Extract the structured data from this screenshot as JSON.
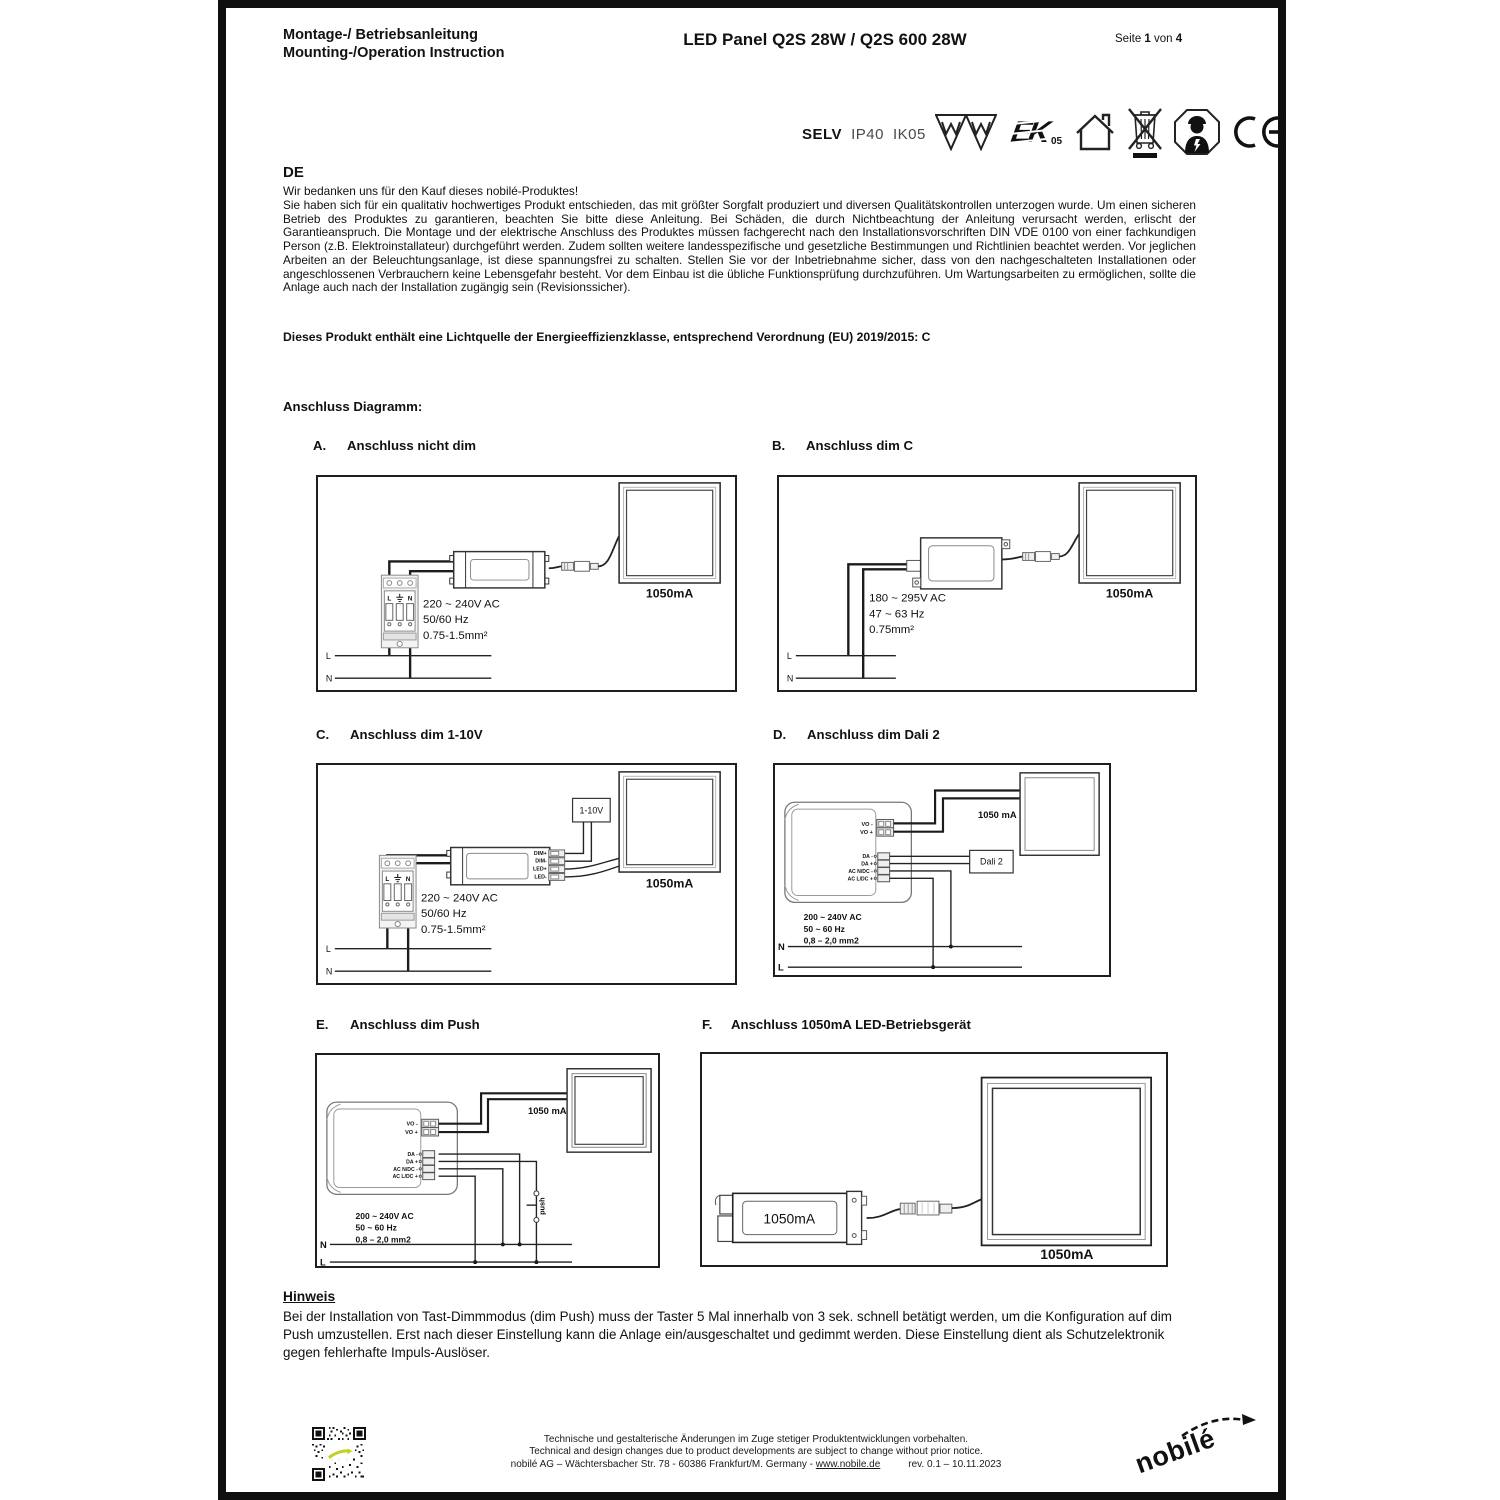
{
  "header": {
    "doc_title_line1": "Montage-/ Betriebsanleitung",
    "doc_title_line2": "Mounting-/Operation Instruction",
    "product_title": "LED Panel Q2S 28W / Q2S 600 28W",
    "page_prefix": "Seite ",
    "page_number": "1",
    "page_middle": " von ",
    "page_total": "4"
  },
  "certs": {
    "selv": "SELV",
    "ip": "IP40",
    "ik": "IK05",
    "enec_text": "EK",
    "enec_number": "05",
    "icons": [
      "selv-label",
      "ip-rating",
      "ik-rating",
      "transformer-triangle-icon",
      "transformer-triangle-icon",
      "enec-mark-icon",
      "indoor-use-icon",
      "weee-bin-icon",
      "electrician-icon",
      "ce-mark-icon"
    ]
  },
  "intro": {
    "lang": "DE",
    "greeting": "Wir bedanken uns für den Kauf dieses nobilé-Produktes!",
    "body": "Sie haben sich für ein qualitativ hochwertiges Produkt entschieden, das mit größter Sorgfalt produziert und diversen Qualitätskontrollen unterzogen wurde. Um einen sicheren Betrieb des Produktes zu garantieren, beachten Sie bitte diese Anleitung. Bei Schäden, die durch Nichtbeachtung der Anleitung verursacht werden, erlischt der Garantieanspruch. Die Montage und der elektrische Anschluss des Produktes müssen fachgerecht nach den Installationsvorschriften DIN VDE 0100 von einer fachkundigen Person (z.B. Elektroinstallateur) durchgeführt werden. Zudem sollten weitere landesspezifische und gesetzliche Bestimmungen und Richtlinien beachtet werden. Vor jeglichen Arbeiten an der Beleuchtungsanlage, ist diese spannungsfrei zu schalten. Stellen Sie vor der Inbetriebnahme sicher, dass von den nachgeschalteten Installationen oder angeschlossenen Verbrauchern keine Lebensgefahr besteht. Vor dem Einbau ist die übliche Funktionsprüfung durchzuführen. Um Wartungsarbeiten zu ermöglichen, sollte die Anlage auch nach der Installation zugängig sein (Revisionssicher).",
    "energy_note": "Dieses Produkt enthält eine Lichtquelle der Energieeffizienzklasse, entsprechend Verordnung (EU) 2019/2015: C"
  },
  "diagram_heading": "Anschluss Diagramm:",
  "sections": {
    "a": {
      "letter": "A.",
      "title": "Anschluss nicht dim"
    },
    "b": {
      "letter": "B.",
      "title": "Anschluss dim C"
    },
    "c": {
      "letter": "C.",
      "title": "Anschluss dim 1-10V"
    },
    "d": {
      "letter": "D.",
      "title": "Anschluss dim Dali 2"
    },
    "e": {
      "letter": "E.",
      "title": "Anschluss dim Push"
    },
    "f": {
      "letter": "F.",
      "title": "Anschluss 1050mA LED-Betriebsgerät"
    }
  },
  "diagrams": {
    "a": {
      "panel_label": "1050mA",
      "supply": [
        "220 ~ 240V AC",
        "50/60 Hz",
        "0.75-1.5mm²"
      ],
      "line_l": "L",
      "line_n": "N",
      "terminal_l": "L",
      "terminal_n": "N"
    },
    "b": {
      "panel_label": "1050mA",
      "supply": [
        "180 ~ 295V AC",
        "47 ~ 63 Hz",
        "0.75mm²"
      ],
      "line_l": "L",
      "line_n": "N"
    },
    "c": {
      "panel_label": "1050mA",
      "dim_unit": "1-10V",
      "terminals": [
        "DIM+",
        "DIM-",
        "LED+",
        "LED-"
      ],
      "supply": [
        "220 ~ 240V AC",
        "50/60 Hz",
        "0.75-1.5mm²"
      ],
      "line_l": "L",
      "line_n": "N",
      "terminal_l": "L",
      "terminal_n": "N"
    },
    "d": {
      "panel_label": "1050 mA",
      "dali_unit": "Dali 2",
      "terminals": [
        "VO -",
        "VO +",
        "DA -",
        "DA +",
        "AC N/DC -",
        "AC L/DC +"
      ],
      "supply": [
        "200 ~ 240V AC",
        "50 ~ 60 Hz",
        "0,8 – 2,0 mm2"
      ],
      "line_n": "N",
      "line_l": "L"
    },
    "e": {
      "panel_label": "1050 mA",
      "push_label": "push",
      "terminals": [
        "VO -",
        "VO +",
        "DA -",
        "DA +",
        "AC N/DC -",
        "AC L/DC +"
      ],
      "supply": [
        "200 ~ 240V AC",
        "50 ~ 60 Hz",
        "0,8 – 2,0 mm2"
      ],
      "line_n": "N",
      "line_l": "L"
    },
    "f": {
      "driver_label": "1050mA",
      "panel_label": "1050mA"
    }
  },
  "hinweis": {
    "title": "Hinweis",
    "body": "Bei der Installation von Tast-Dimmmodus (dim Push) muss der Taster 5 Mal innerhalb von 3 sek. schnell betätigt werden, um die Konfiguration auf dim Push umzustellen. Erst nach dieser Einstellung kann die Anlage ein/ausgeschaltet und gedimmt werden. Diese Einstellung dient als Schutzelektronik gegen fehlerhafte Impuls-Auslöser."
  },
  "footer": {
    "note_de": "Technische und gestalterische Änderungen im Zuge stetiger Produktentwicklungen vorbehalten.",
    "note_en": "Technical and design changes due to product developments are subject to change without prior notice.",
    "company": "nobilé AG – Wächtersbacher Str. 78 - 60386 Frankfurt/M. Germany - ",
    "website": "www.nobile.de",
    "revision": "rev. 0.1 – 10.11.2023",
    "logo_text": "nobilé"
  }
}
